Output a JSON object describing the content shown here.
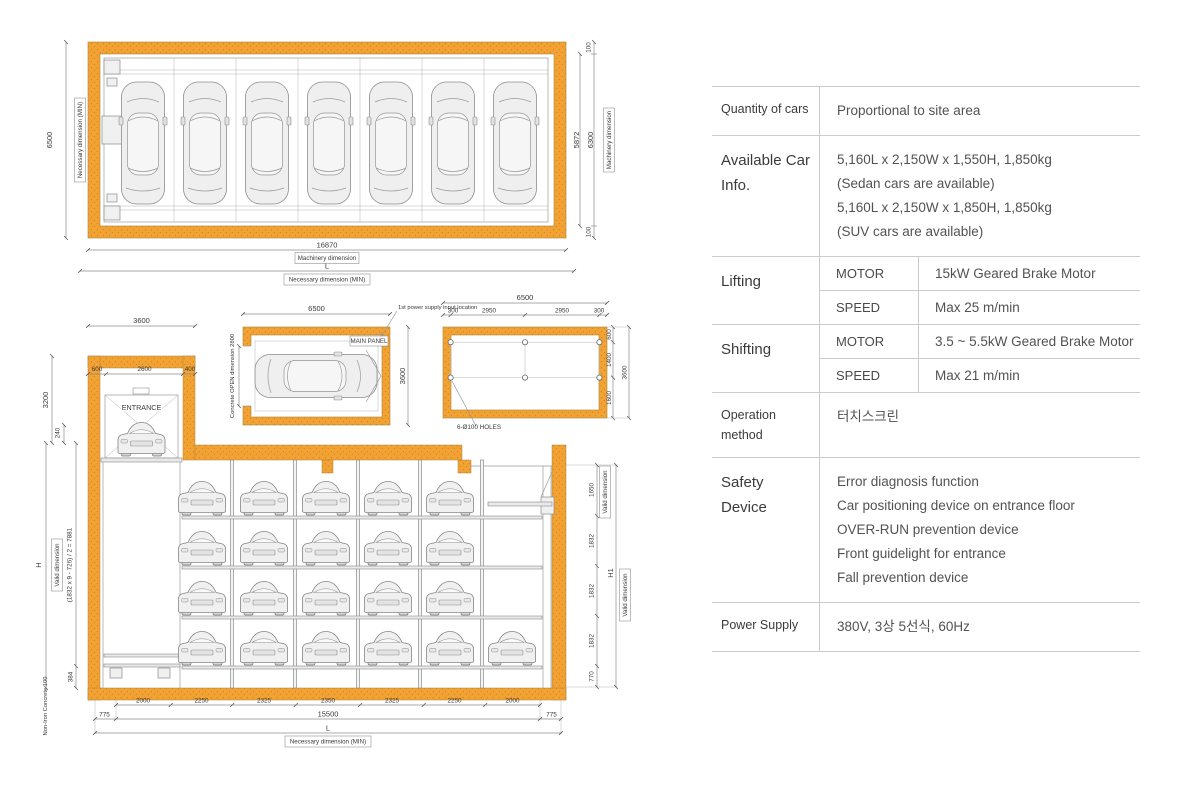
{
  "diagram": {
    "plan": {
      "left_dim": "6500",
      "left_label": "Necessary dimension (MIN)",
      "right_offset_top": "100",
      "right_offset_bottom": "100",
      "right_dim_inner": "5872",
      "right_dim_outer": "6300",
      "right_label": "Machinery dimension",
      "bottom_dim": "16870",
      "bottom_dim_label": "Machinery dimension",
      "bottom_total": "L",
      "bottom_total_label": "Necessary dimension (MIN)"
    },
    "entrance_plan": {
      "top_dim": "3600",
      "sub_dims": [
        "600",
        "2600",
        "400"
      ],
      "height_dim": "3200",
      "floor_dim": "240",
      "entrance_label": "ENTRANCE"
    },
    "pit_plan": {
      "top_dim": "6500",
      "power_note": "1st power supply input location",
      "panel_label": "MAIN PANEL",
      "right_dim": "3600",
      "open_label": "Concrete OPEN dimension 2800"
    },
    "foundation_plan": {
      "top_dim": "6500",
      "sub_dims": [
        "300",
        "2950",
        "2950",
        "300"
      ],
      "right_dims": [
        "600",
        "1400",
        "1600"
      ],
      "right_total": "3600",
      "holes_label": "6-Ø100 HOLES"
    },
    "elevation": {
      "left_formula": "(1832 x 9 - 726) / 2 = 7881",
      "left_valid_label": "Valid dimension",
      "left_total": "H",
      "left_floor_dim": "384",
      "concrete_label": "Non-Iron Concrete 100",
      "right_dims": [
        "1650",
        "1832",
        "1832",
        "1832",
        "770"
      ],
      "right_valid_label": "Valid dimension",
      "right_total": "H1",
      "right_total_label": "Valid dimension",
      "bottom_offset_left": "775",
      "bottom_offset_right": "775",
      "bottom_segments": [
        "2000",
        "2250",
        "2325",
        "2350",
        "2325",
        "2250",
        "2000"
      ],
      "bottom_total": "15500",
      "bottom_overall": "L",
      "bottom_overall_label": "Necessary dimension (MIN)"
    }
  },
  "spec_table": {
    "rows": [
      {
        "label": "Quantity of cars",
        "value": "Proportional to site area"
      },
      {
        "label": "Available Car Info.",
        "lines": [
          "5,160L x 2,150W x 1,550H, 1,850kg",
          "(Sedan cars are available)",
          "5,160L x 2,150W x 1,850H, 1,850kg",
          "(SUV cars are available)"
        ]
      },
      {
        "label": "Lifting",
        "sub": [
          {
            "key": "MOTOR",
            "value": "15kW Geared Brake Motor"
          },
          {
            "key": "SPEED",
            "value": "Max 25 m/min"
          }
        ]
      },
      {
        "label": "Shifting",
        "sub": [
          {
            "key": "MOTOR",
            "value": "3.5 ~ 5.5kW Geared Brake Motor"
          },
          {
            "key": "SPEED",
            "value": "Max 21 m/min"
          }
        ]
      },
      {
        "label": "Operation method",
        "value": "터치스크린"
      },
      {
        "label": "Safety Device",
        "lines": [
          "Error diagnosis function",
          "Car positioning device on entrance floor",
          "OVER-RUN prevention device",
          "Front guidelight for entrance",
          "Fall prevention device"
        ]
      },
      {
        "label": "Power Supply",
        "value": "380V, 3상 5선식, 60Hz"
      }
    ]
  },
  "colors": {
    "wall_orange": "#F2A233",
    "wall_speckle": "#D0821C",
    "table_border": "#CBCBCB"
  }
}
